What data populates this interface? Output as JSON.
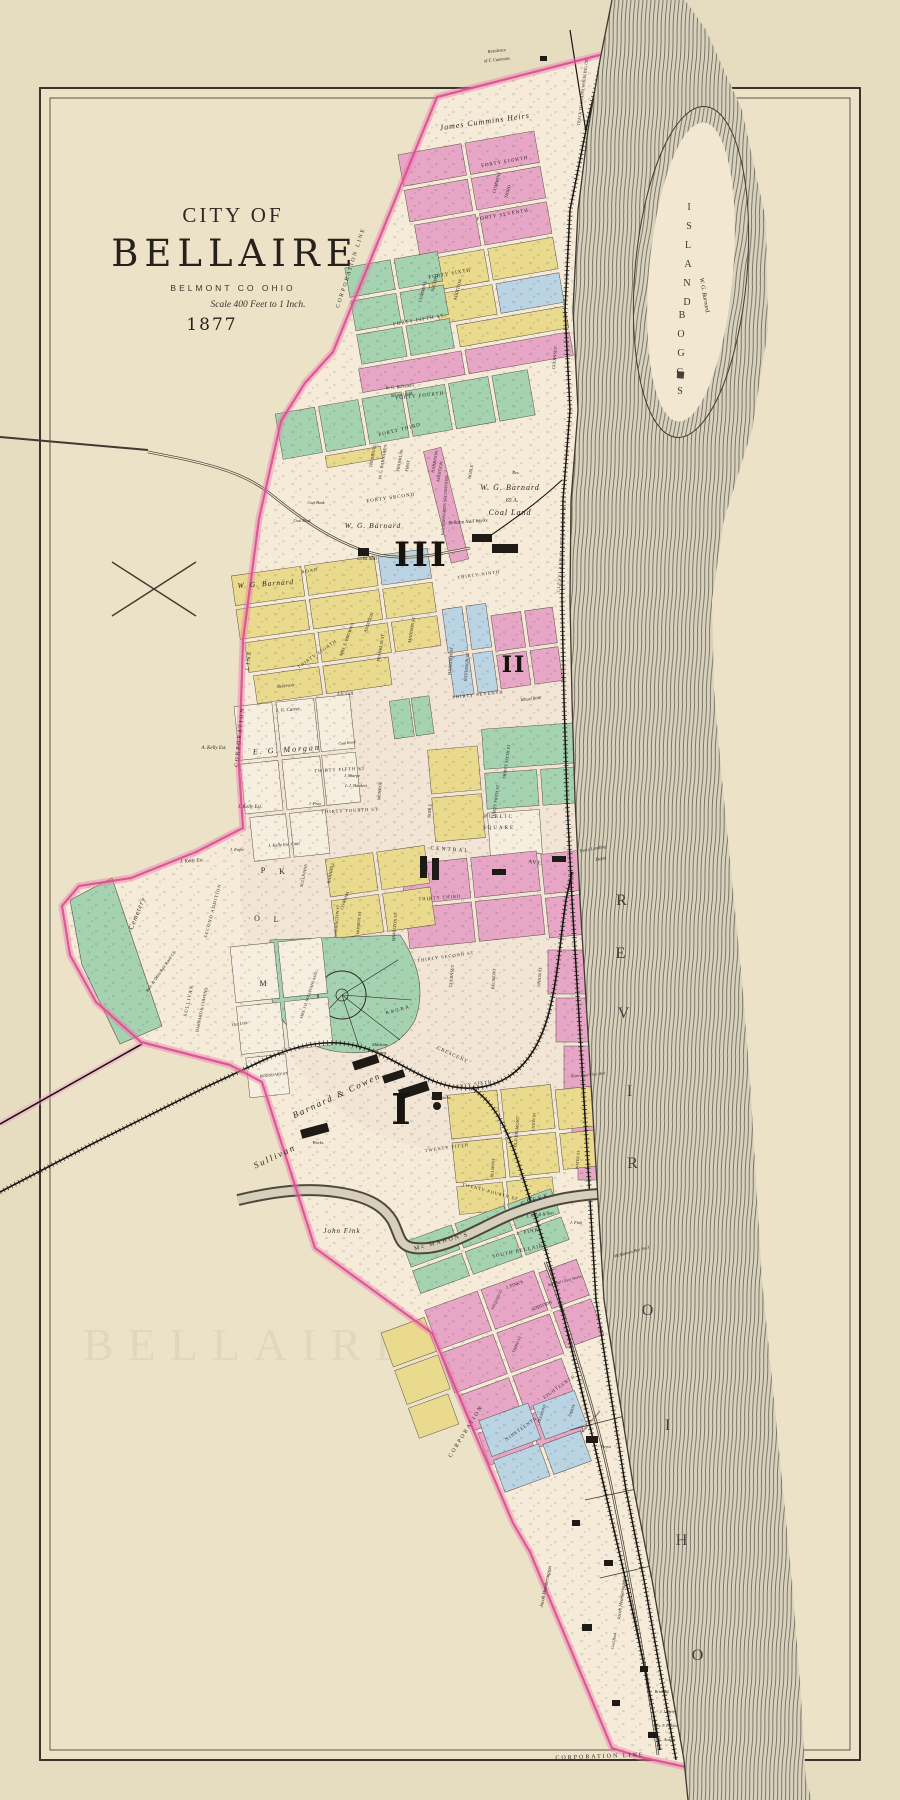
{
  "title": {
    "prefix": "City of",
    "name": "BELLAIRE",
    "county": "BELMONT CO OHIO",
    "scale": "Scale 400 Feet to 1 Inch.",
    "year": "1877"
  },
  "ghost_text": "BELLAIRE",
  "wards": [
    {
      "numeral": "III",
      "x": 421,
      "y": 566,
      "s": 34
    },
    {
      "numeral": "II",
      "x": 514,
      "y": 672,
      "s": 22
    },
    {
      "numeral": "I",
      "x": 402,
      "y": 1124,
      "s": 42
    }
  ],
  "river": {
    "name": "OHIO RIVER",
    "letters": [
      {
        "ch": "O",
        "x": 698,
        "y": 1660
      },
      {
        "ch": "H",
        "x": 682,
        "y": 1545
      },
      {
        "ch": "I",
        "x": 668,
        "y": 1430
      },
      {
        "ch": "O",
        "x": 648,
        "y": 1315
      },
      {
        "ch": "R",
        "x": 633,
        "y": 1168
      },
      {
        "ch": "I",
        "x": 630,
        "y": 1096
      },
      {
        "ch": "V",
        "x": 624,
        "y": 1018
      },
      {
        "ch": "E",
        "x": 621,
        "y": 958
      },
      {
        "ch": "R",
        "x": 622,
        "y": 905
      }
    ]
  },
  "island": {
    "name": "BOGGS ISLAND",
    "owner": "W. G. Barnard.",
    "letters": [
      {
        "ch": "B",
        "x": 682,
        "y": 318
      },
      {
        "ch": "O",
        "x": 681,
        "y": 337
      },
      {
        "ch": "G",
        "x": 681,
        "y": 356
      },
      {
        "ch": "G",
        "x": 680,
        "y": 375
      },
      {
        "ch": "S",
        "x": 680,
        "y": 394
      },
      {
        "ch": "I",
        "x": 689,
        "y": 210
      },
      {
        "ch": "S",
        "x": 689,
        "y": 229
      },
      {
        "ch": "L",
        "x": 688,
        "y": 248
      },
      {
        "ch": "A",
        "x": 688,
        "y": 267
      },
      {
        "ch": "N",
        "x": 687,
        "y": 286
      },
      {
        "ch": "D",
        "x": 687,
        "y": 305
      }
    ]
  },
  "colors": {
    "paper_outer": "#e6dcc0",
    "paper_inner": "#ece2c8",
    "city_paper": "#f5ebd8",
    "block_pink": "#e7a6c6",
    "block_yellow": "#eada8d",
    "block_green": "#a5d2b0",
    "block_blue": "#bad4e4",
    "block_white": "#f6efdf",
    "boundary_pink": "#d94f92",
    "river_base": "#d8d1bc",
    "river_ink": "#57524a",
    "rail_ink": "#181611"
  },
  "labels": [
    {
      "t": "Residence",
      "x": 497,
      "y": 52,
      "r": -6,
      "s": 4.5,
      "i": true
    },
    {
      "t": "of T. Cummins",
      "x": 497,
      "y": 61,
      "r": -6,
      "s": 4.5,
      "i": true
    },
    {
      "t": "James Cummins Heirs",
      "x": 485,
      "y": 124,
      "r": -8,
      "s": 8,
      "sp": 1,
      "i": true
    },
    {
      "t": "TRACK TO MOUTH WHEELING CR.",
      "x": 584,
      "y": 92,
      "r": -83,
      "s": 4.2
    },
    {
      "t": "FORTY EIGHTH",
      "x": 505,
      "y": 163,
      "r": -10,
      "s": 5,
      "sp": 1
    },
    {
      "t": "FORTY SEVENTH",
      "x": 503,
      "y": 216,
      "r": -10,
      "s": 5,
      "sp": 1
    },
    {
      "t": "FORTY SIXTH",
      "x": 450,
      "y": 275,
      "r": -10,
      "s": 5,
      "sp": 1
    },
    {
      "t": "FORTY FIFTH ST.",
      "x": 420,
      "y": 321,
      "r": -10,
      "s": 5,
      "sp": 1
    },
    {
      "t": "FORTY FOURTH",
      "x": 420,
      "y": 397,
      "r": -6,
      "s": 5,
      "sp": 1
    },
    {
      "t": "FORTY THIRD",
      "x": 400,
      "y": 431,
      "r": -14,
      "s": 5,
      "sp": 1
    },
    {
      "t": "FORTY SECOND",
      "x": 391,
      "y": 499,
      "r": -8,
      "s": 5,
      "sp": 1
    },
    {
      "t": "CUMMINS",
      "x": 498,
      "y": 183,
      "r": -75,
      "s": 4.5
    },
    {
      "t": "THIRD",
      "x": 509,
      "y": 192,
      "r": -75,
      "s": 4.5
    },
    {
      "t": "CUMMINS",
      "x": 424,
      "y": 292,
      "r": -75,
      "s": 4.5
    },
    {
      "t": "SECOND",
      "x": 436,
      "y": 283,
      "r": -75,
      "s": 4.5
    },
    {
      "t": "ADDITION",
      "x": 459,
      "y": 290,
      "r": -75,
      "s": 4.5
    },
    {
      "t": "CORPORATION LINE",
      "x": 352,
      "y": 268,
      "r": -72,
      "s": 5.5,
      "sp": 2
    },
    {
      "t": "W. G. Barnard's",
      "x": 400,
      "y": 388,
      "r": -6,
      "s": 4.5,
      "i": true
    },
    {
      "t": "Second Add.",
      "x": 402,
      "y": 396,
      "r": -6,
      "s": 4.5,
      "i": true
    },
    {
      "t": "W. G. BARNARD'S",
      "x": 384,
      "y": 462,
      "r": -80,
      "s": 4.3
    },
    {
      "t": "FIRST",
      "x": 409,
      "y": 466,
      "r": -80,
      "s": 4.3
    },
    {
      "t": "ADDITION",
      "x": 441,
      "y": 472,
      "r": -80,
      "s": 4.3
    },
    {
      "t": "TRUMBULL",
      "x": 374,
      "y": 456,
      "r": -80,
      "s": 4.3
    },
    {
      "t": "FRANKLIN",
      "x": 401,
      "y": 461,
      "r": -80,
      "s": 4.3
    },
    {
      "t": "HARRISON",
      "x": 436,
      "y": 462,
      "r": -80,
      "s": 4.3
    },
    {
      "t": "NOBLE",
      "x": 472,
      "y": 472,
      "r": -80,
      "s": 4.3
    },
    {
      "t": "W.G.BARNARD'S SECOND ADD.",
      "x": 446,
      "y": 505,
      "r": -86,
      "s": 4.2
    },
    {
      "t": "CLEVELAND & PITTSBURGH R.R.",
      "x": 563,
      "y": 545,
      "r": -86,
      "s": 4.4,
      "sp": 1
    },
    {
      "t": "Res.",
      "x": 516,
      "y": 474,
      "r": 0,
      "s": 4.5,
      "i": true
    },
    {
      "t": "W. G. Barnard",
      "x": 510,
      "y": 490,
      "r": 0,
      "s": 8,
      "sp": 1,
      "i": true
    },
    {
      "t": "65 A.",
      "x": 512,
      "y": 502,
      "r": 0,
      "s": 6,
      "i": true
    },
    {
      "t": "Coal Land",
      "x": 510,
      "y": 515,
      "r": 0,
      "s": 8,
      "sp": 1,
      "i": true
    },
    {
      "t": "W. G. Barnard",
      "x": 373,
      "y": 528,
      "r": 0,
      "s": 7.5,
      "sp": 1,
      "i": true
    },
    {
      "t": "W. G. Barnard",
      "x": 266,
      "y": 586,
      "r": -4,
      "s": 7.5,
      "sp": 1,
      "i": true
    },
    {
      "t": "Grist Mill",
      "x": 367,
      "y": 560,
      "r": 0,
      "s": 5,
      "i": true
    },
    {
      "t": "Coal Bank",
      "x": 316,
      "y": 504,
      "r": 0,
      "s": 4,
      "i": true
    },
    {
      "t": "Coal Bank",
      "x": 302,
      "y": 522,
      "r": 0,
      "s": 4,
      "i": true
    },
    {
      "t": "ROAD",
      "x": 310,
      "y": 572,
      "r": -10,
      "s": 4.5,
      "sp": 1
    },
    {
      "t": "Bellaire Nail Works",
      "x": 468,
      "y": 523,
      "r": -4,
      "s": 5,
      "i": true
    },
    {
      "t": "Wharf Boat",
      "x": 531,
      "y": 700,
      "r": -8,
      "s": 4.5,
      "i": true
    },
    {
      "t": "Ferry Landing",
      "x": 593,
      "y": 850,
      "r": -10,
      "s": 4.5,
      "i": true
    },
    {
      "t": "Depot",
      "x": 601,
      "y": 860,
      "r": -10,
      "s": 4.5,
      "i": true
    },
    {
      "t": "MRS. E. BROWN'S",
      "x": 348,
      "y": 640,
      "r": -70,
      "s": 4.3
    },
    {
      "t": "ADDITION",
      "x": 370,
      "y": 623,
      "r": -70,
      "s": 4.3
    },
    {
      "t": "MADISON ST",
      "x": 413,
      "y": 630,
      "r": -80,
      "s": 4.3
    },
    {
      "t": "FRANKLIN ST",
      "x": 382,
      "y": 648,
      "r": -80,
      "s": 4.3
    },
    {
      "t": "THIRTY EIGHTH",
      "x": 318,
      "y": 655,
      "r": -35,
      "s": 4.5,
      "sp": 1
    },
    {
      "t": "HARRISON ST",
      "x": 452,
      "y": 661,
      "r": -85,
      "s": 4.3
    },
    {
      "t": "JEFFERSON ST",
      "x": 468,
      "y": 667,
      "r": -85,
      "s": 4.3
    },
    {
      "t": "THIRTY NINTH",
      "x": 479,
      "y": 576,
      "r": -8,
      "s": 4.5,
      "sp": 1
    },
    {
      "t": "THIRTY SEVENTH",
      "x": 478,
      "y": 696,
      "r": -6,
      "s": 4.5,
      "sp": 1
    },
    {
      "t": "THIRTY SIXTH ST",
      "x": 508,
      "y": 762,
      "r": -82,
      "s": 4.3
    },
    {
      "t": "THIRTY FIFTH ST",
      "x": 497,
      "y": 802,
      "r": -82,
      "s": 4.3
    },
    {
      "t": "THIRTY FIFTH ST",
      "x": 340,
      "y": 771,
      "r": -3,
      "s": 4.5,
      "sp": 1
    },
    {
      "t": "THIRTY FOURTH ST",
      "x": 350,
      "y": 812,
      "r": -3,
      "s": 4.5,
      "sp": 1
    },
    {
      "t": "CORPORATION",
      "x": 241,
      "y": 737,
      "r": -84,
      "s": 5.5,
      "sp": 2
    },
    {
      "t": "LINE",
      "x": 250,
      "y": 660,
      "r": -84,
      "s": 5.5,
      "sp": 2
    },
    {
      "t": "Reservoir",
      "x": 286,
      "y": 687,
      "r": -6,
      "s": 4.5,
      "i": true
    },
    {
      "t": "J. C. Carter",
      "x": 288,
      "y": 711,
      "r": -4,
      "s": 5,
      "i": true
    },
    {
      "t": "J.S. Gill",
      "x": 345,
      "y": 695,
      "r": 0,
      "s": 5,
      "i": true
    },
    {
      "t": "E. G. Morgan",
      "x": 287,
      "y": 752,
      "r": -4,
      "s": 8,
      "sp": 2,
      "i": true
    },
    {
      "t": "Coal Road",
      "x": 347,
      "y": 744,
      "r": -6,
      "s": 4,
      "i": true
    },
    {
      "t": "J. Kelly Est.",
      "x": 250,
      "y": 808,
      "r": 0,
      "s": 5,
      "i": true
    },
    {
      "t": "A. Kelly Est.",
      "x": 214,
      "y": 749,
      "r": 0,
      "s": 5,
      "i": true
    },
    {
      "t": "J. Kelly Est.",
      "x": 192,
      "y": 862,
      "r": -4,
      "s": 5,
      "i": true
    },
    {
      "t": "J. Kelly Est. Coal",
      "x": 284,
      "y": 846,
      "r": -4,
      "s": 4.5,
      "i": true
    },
    {
      "t": "J. Enfer",
      "x": 237,
      "y": 851,
      "r": 0,
      "s": 4.5,
      "i": true
    },
    {
      "t": "L.J. Hackett",
      "x": 356,
      "y": 787,
      "r": 0,
      "s": 4.5,
      "i": true
    },
    {
      "t": "J. Sharpe",
      "x": 352,
      "y": 777,
      "r": 0,
      "s": 4.3,
      "i": true
    },
    {
      "t": "J. Pray",
      "x": 315,
      "y": 805,
      "r": 0,
      "s": 4.3,
      "i": true
    },
    {
      "t": "PUBLIC",
      "x": 499,
      "y": 818,
      "r": 0,
      "s": 5,
      "sp": 2
    },
    {
      "t": "SQUARE",
      "x": 499,
      "y": 829,
      "r": 0,
      "s": 5,
      "sp": 2
    },
    {
      "t": "CENTRAL",
      "x": 450,
      "y": 851,
      "r": 4,
      "s": 5.5,
      "sp": 2
    },
    {
      "t": "AVE.",
      "x": 536,
      "y": 864,
      "r": 7,
      "s": 5.5,
      "sp": 1
    },
    {
      "t": "THIRTY THIRD",
      "x": 440,
      "y": 899,
      "r": -4,
      "s": 4.5,
      "sp": 1
    },
    {
      "t": "THIRTY SECOND ST",
      "x": 446,
      "y": 958,
      "r": -8,
      "s": 4.5,
      "sp": 1
    },
    {
      "t": "NOBLE",
      "x": 431,
      "y": 811,
      "r": -85,
      "s": 4.3
    },
    {
      "t": "MONROE",
      "x": 381,
      "y": 791,
      "r": -85,
      "s": 4.3
    },
    {
      "t": "GUERNSEY",
      "x": 453,
      "y": 976,
      "r": -85,
      "s": 4.3
    },
    {
      "t": "GUERNSEY",
      "x": 556,
      "y": 358,
      "r": -85,
      "s": 4.3
    },
    {
      "t": "BELMONT",
      "x": 495,
      "y": 979,
      "r": -85,
      "s": 4.3
    },
    {
      "t": "HAMILTON ST",
      "x": 396,
      "y": 927,
      "r": -85,
      "s": 4.3
    },
    {
      "t": "UNION ST",
      "x": 541,
      "y": 977,
      "r": -85,
      "s": 4.3
    },
    {
      "t": "SULLIVANS",
      "x": 305,
      "y": 876,
      "r": -78,
      "s": 4.3
    },
    {
      "t": "BARNHILL",
      "x": 332,
      "y": 873,
      "r": -78,
      "s": 4.3
    },
    {
      "t": "WASHINGTON ST",
      "x": 338,
      "y": 921,
      "r": -85,
      "s": 4
    },
    {
      "t": "MONROE ST",
      "x": 360,
      "y": 923,
      "r": -85,
      "s": 4
    },
    {
      "t": "COWEN'S",
      "x": 346,
      "y": 901,
      "r": -70,
      "s": 4.3
    },
    {
      "t": "P",
      "x": 263,
      "y": 873,
      "r": 0,
      "s": 8
    },
    {
      "t": "K",
      "x": 282,
      "y": 874,
      "r": 0,
      "s": 8
    },
    {
      "t": "O",
      "x": 257,
      "y": 921,
      "r": 0,
      "s": 8
    },
    {
      "t": "L",
      "x": 276,
      "y": 922,
      "r": 0,
      "s": 8
    },
    {
      "t": "M",
      "x": 263,
      "y": 986,
      "r": 0,
      "s": 8
    },
    {
      "t": "Cemetery",
      "x": 139,
      "y": 914,
      "r": -68,
      "s": 7,
      "sp": 1,
      "i": true
    },
    {
      "t": "SULLIVAN",
      "x": 190,
      "y": 1001,
      "r": -78,
      "s": 5,
      "sp": 1
    },
    {
      "t": "BARNARD & COWEN'S",
      "x": 203,
      "y": 1010,
      "r": -78,
      "s": 4.3
    },
    {
      "t": "SECOND ADDITION",
      "x": 214,
      "y": 911,
      "r": -75,
      "s": 4.5,
      "sp": 1
    },
    {
      "t": "MRS. J.H. SULLIVANS ADD.",
      "x": 310,
      "y": 995,
      "r": -72,
      "s": 4
    },
    {
      "t": "Out Lots",
      "x": 240,
      "y": 1025,
      "r": -10,
      "s": 4.5,
      "i": true
    },
    {
      "t": "BOUNDARY ST",
      "x": 274,
      "y": 1076,
      "r": -6,
      "s": 4
    },
    {
      "t": "Balt. & Ohio Rail Road Co.",
      "x": 162,
      "y": 972,
      "r": -55,
      "s": 4.5,
      "i": true
    },
    {
      "t": "B. & O. R. R.",
      "x": 398,
      "y": 1011,
      "r": -15,
      "s": 4.5
    },
    {
      "t": "CRESCENT",
      "x": 452,
      "y": 1056,
      "r": 25,
      "s": 5,
      "sp": 1
    },
    {
      "t": "Machine",
      "x": 380,
      "y": 1046,
      "r": 0,
      "s": 4.5,
      "i": true
    },
    {
      "t": "Shops",
      "x": 381,
      "y": 1054,
      "r": 0,
      "s": 4.5,
      "i": true
    },
    {
      "t": "Works",
      "x": 318,
      "y": 1144,
      "r": 0,
      "s": 4.5,
      "i": true
    },
    {
      "t": "Gas Works",
      "x": 441,
      "y": 1099,
      "r": 0,
      "s": 4.5,
      "i": true
    },
    {
      "t": "Sullivan",
      "x": 276,
      "y": 1159,
      "r": -25,
      "s": 9,
      "sp": 2,
      "i": true
    },
    {
      "t": "Barnard & Cowen",
      "x": 338,
      "y": 1098,
      "r": -25,
      "s": 9,
      "sp": 2,
      "i": true
    },
    {
      "t": "TWENTY SIXTH",
      "x": 470,
      "y": 1086,
      "r": -8,
      "s": 4.5,
      "sp": 1
    },
    {
      "t": "TWENTY FIFTH",
      "x": 447,
      "y": 1149,
      "r": -8,
      "s": 4.5,
      "sp": 1
    },
    {
      "t": "TWENTY FOURTH ST",
      "x": 490,
      "y": 1193,
      "r": 15,
      "s": 4.3,
      "sp": 1
    },
    {
      "t": "BELMONT",
      "x": 494,
      "y": 1168,
      "r": -85,
      "s": 4
    },
    {
      "t": "OLD BELMONT",
      "x": 518,
      "y": 1132,
      "r": -85,
      "s": 4.3
    },
    {
      "t": "UNION ST",
      "x": 535,
      "y": 1122,
      "r": -85,
      "s": 4
    },
    {
      "t": "WATER ST",
      "x": 579,
      "y": 1160,
      "r": -85,
      "s": 4
    },
    {
      "t": "River View Flint Mill",
      "x": 588,
      "y": 1076,
      "r": -5,
      "s": 4,
      "i": true
    },
    {
      "t": "McMahons Bar No.3",
      "x": 632,
      "y": 1253,
      "r": -15,
      "s": 4.3,
      "i": true
    },
    {
      "t": "John Fink",
      "x": 342,
      "y": 1233,
      "r": 0,
      "s": 7,
      "sp": 1,
      "i": true
    },
    {
      "t": "Mc MAHON'S",
      "x": 442,
      "y": 1243,
      "r": -15,
      "s": 6,
      "sp": 2
    },
    {
      "t": "CREEK",
      "x": 536,
      "y": 1201,
      "r": -18,
      "s": 6,
      "sp": 2
    },
    {
      "t": "J. Nicoll & Son",
      "x": 540,
      "y": 1216,
      "r": -8,
      "s": 4.5,
      "i": true
    },
    {
      "t": "J. FINK",
      "x": 528,
      "y": 1233,
      "r": -10,
      "s": 5,
      "sp": 1
    },
    {
      "t": "J. Fink",
      "x": 576,
      "y": 1224,
      "r": 0,
      "s": 4.5,
      "i": true
    },
    {
      "t": "SOUTH BELLAIRE",
      "x": 520,
      "y": 1252,
      "r": -12,
      "s": 5,
      "sp": 1
    },
    {
      "t": "J. FINK'S",
      "x": 515,
      "y": 1286,
      "r": -20,
      "s": 4.5
    },
    {
      "t": "ADDITION",
      "x": 542,
      "y": 1307,
      "r": -20,
      "s": 4.5
    },
    {
      "t": "National Glass Works",
      "x": 565,
      "y": 1282,
      "r": -15,
      "s": 4,
      "i": true
    },
    {
      "t": "SECOND ST",
      "x": 498,
      "y": 1300,
      "r": -65,
      "s": 4
    },
    {
      "t": "THIRD ST",
      "x": 518,
      "y": 1345,
      "r": -65,
      "s": 4
    },
    {
      "t": "EIGHTEENTH",
      "x": 560,
      "y": 1388,
      "r": -35,
      "s": 4.5,
      "sp": 1
    },
    {
      "t": "NINETEENTH",
      "x": 522,
      "y": 1430,
      "r": -35,
      "s": 4.5,
      "sp": 1
    },
    {
      "t": "BELMONT",
      "x": 543,
      "y": 1414,
      "r": -70,
      "s": 4
    },
    {
      "t": "UNION",
      "x": 573,
      "y": 1411,
      "r": -70,
      "s": 4
    },
    {
      "t": "Coal Train Road",
      "x": 592,
      "y": 1422,
      "r": -50,
      "s": 4,
      "i": true
    },
    {
      "t": "CORPORATION",
      "x": 467,
      "y": 1432,
      "r": -58,
      "s": 5.5,
      "sp": 2
    },
    {
      "t": "Depot",
      "x": 606,
      "y": 1448,
      "r": 0,
      "s": 4,
      "i": true
    },
    {
      "t": "Jacob Heatherington",
      "x": 547,
      "y": 1587,
      "r": -78,
      "s": 5,
      "i": true
    },
    {
      "t": "Jacob Heatherington",
      "x": 623,
      "y": 1599,
      "r": -82,
      "s": 5,
      "i": true
    },
    {
      "t": "Coal Bank",
      "x": 615,
      "y": 1641,
      "r": -80,
      "s": 4,
      "i": true
    },
    {
      "t": "Brick Yd.",
      "x": 662,
      "y": 1693,
      "r": 0,
      "s": 4,
      "i": true
    },
    {
      "t": "J. Lafferty",
      "x": 668,
      "y": 1713,
      "r": 0,
      "s": 4,
      "i": true
    },
    {
      "t": "Mrs. F. Heeson",
      "x": 666,
      "y": 1727,
      "r": 0,
      "s": 4,
      "i": true
    },
    {
      "t": "L. Austin",
      "x": 667,
      "y": 1741,
      "r": 0,
      "s": 4.5,
      "i": true
    },
    {
      "t": "CORPORATION LINE",
      "x": 600,
      "y": 1758,
      "r": -2,
      "s": 6,
      "sp": 2
    }
  ]
}
